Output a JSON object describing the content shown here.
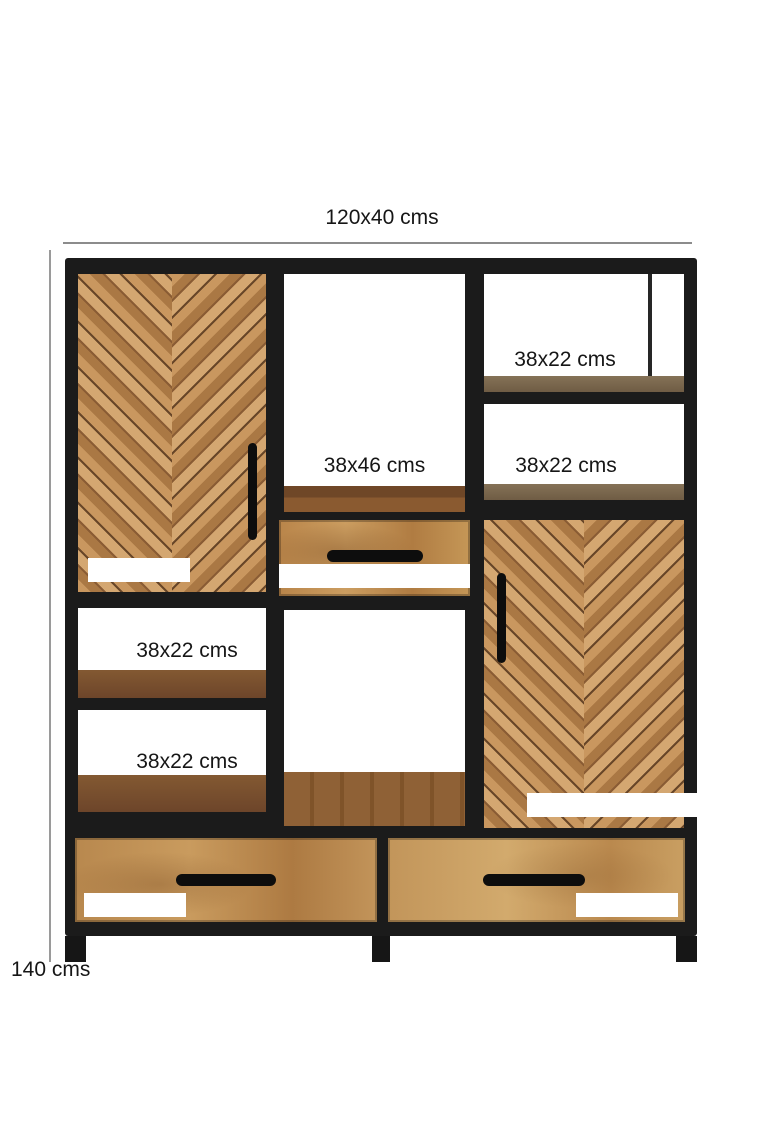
{
  "dimensions": {
    "overall_width_depth": "120x40 cms",
    "overall_height": "140 cms"
  },
  "labels": {
    "left_door": "62x37 cms",
    "right_door": "62x37 cms",
    "middle_open_shelf": "38x46 cms",
    "middle_drawer": "38x14 cms",
    "right_top_shelf": "38x22 cms",
    "right_middle_shelf": "38x22 cms",
    "left_middle_shelf": "38x22 cms",
    "left_lower_shelf": "38x22 cms",
    "bottom_left_drawer": "57x14 cms",
    "bottom_right_drawer": "57x14 cms"
  },
  "colors": {
    "frame_black": "#1b1b1b",
    "wood_plank_light": "#d4a771",
    "wood_plank_medium": "#aa7844",
    "wood_plank_dark": "#684628",
    "shelf_wood_brown": "#7c5231",
    "shelf_wood_gray": "#7d6b54",
    "drawer_wood": "#c2955a",
    "dimension_line_gray": "#8c8c8c",
    "label_text_dark": "#161616",
    "label_text_light": "#ffffff"
  }
}
